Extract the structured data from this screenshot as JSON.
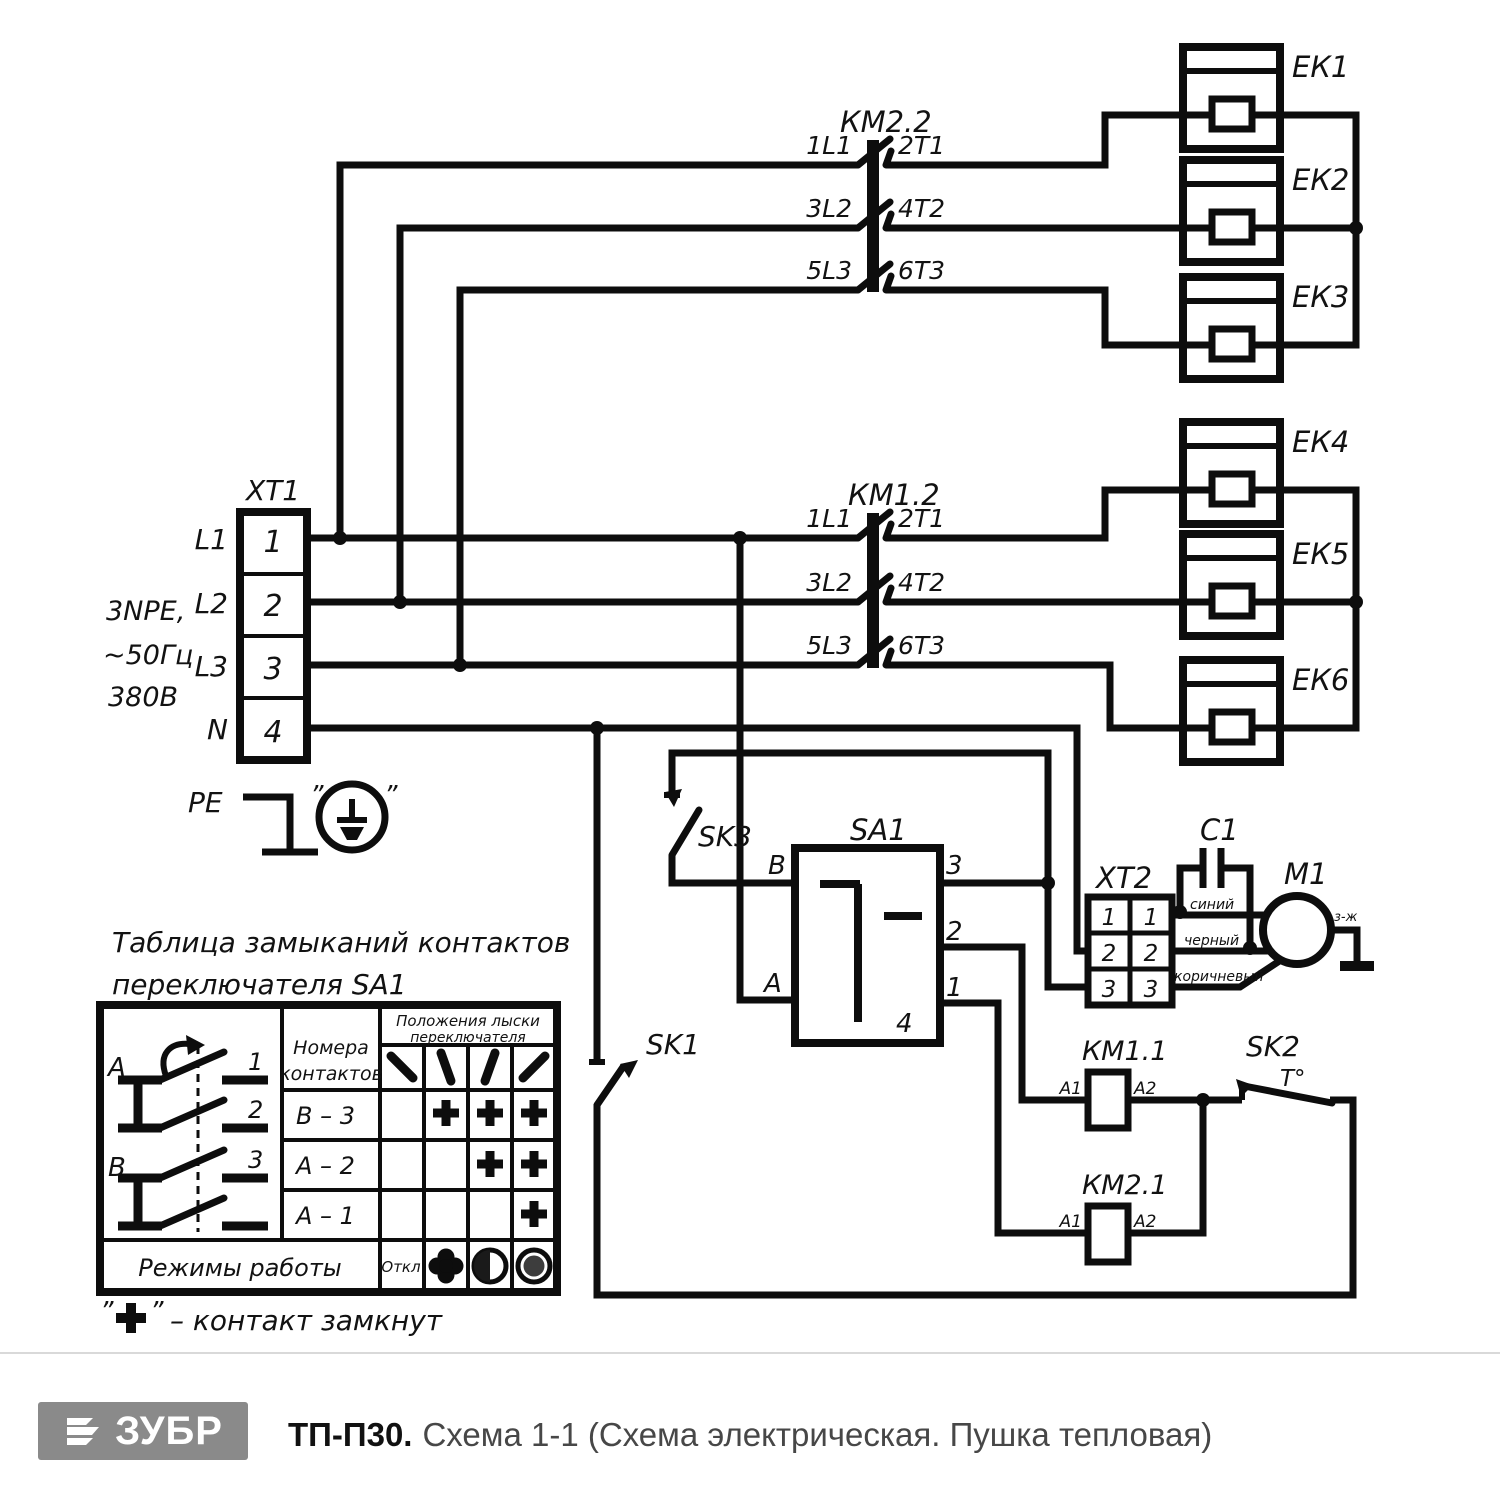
{
  "schematic": {
    "quote": "”",
    "xt1": {
      "title": "ХТ1",
      "phases": [
        "L1",
        "L2",
        "L3",
        "N"
      ],
      "terminals": [
        "1",
        "2",
        "3",
        "4"
      ],
      "supply": [
        "3NPE,",
        "~50Гц",
        "380В"
      ],
      "pe": "PE"
    },
    "km22": {
      "title": "КМ2.2",
      "poles": [
        {
          "in": "1L1",
          "out": "2Т1"
        },
        {
          "in": "3L2",
          "out": "4Т2"
        },
        {
          "in": "5L3",
          "out": "6Т3"
        }
      ]
    },
    "km12": {
      "title": "КМ1.2",
      "poles": [
        {
          "in": "1L1",
          "out": "2Т1"
        },
        {
          "in": "3L2",
          "out": "4Т2"
        },
        {
          "in": "5L3",
          "out": "6Т3"
        }
      ]
    },
    "heaters": [
      "ЕК1",
      "ЕК2",
      "ЕК3",
      "ЕК4",
      "ЕК5",
      "ЕК6"
    ],
    "sa1": {
      "title": "SA1",
      "b": "B",
      "a": "A",
      "t3": "3",
      "t2": "2",
      "t1": "1",
      "t4": "4"
    },
    "sk1": "SK1",
    "sk3": "SK3",
    "sk2": {
      "title": "SK2",
      "temp": "Т°"
    },
    "xt2": {
      "title": "ХТ2",
      "left": [
        "1",
        "2",
        "3"
      ],
      "right": [
        "1",
        "2",
        "3"
      ]
    },
    "c1": "С1",
    "m1": "М1",
    "wire_colors": {
      "blue": "синий",
      "black": "черный",
      "brown": "коричневый"
    },
    "ground_mark": "з-ж",
    "km11": {
      "title": "КМ1.1",
      "a1": "А1",
      "a2": "А2"
    },
    "km21": {
      "title": "КМ2.1",
      "a1": "А1",
      "a2": "А2"
    }
  },
  "table": {
    "title_line1": "Таблица замыканий контактов",
    "title_line2": "переключателя SA1",
    "contacts_header": [
      "Номера",
      "контактов"
    ],
    "positions_header": [
      "Положения лыски",
      "переключателя"
    ],
    "rows": [
      {
        "contacts": "B – 3",
        "closed_positions": [
          2,
          3,
          4
        ]
      },
      {
        "contacts": "A – 2",
        "closed_positions": [
          3,
          4
        ]
      },
      {
        "contacts": "A – 1",
        "closed_positions": [
          4
        ]
      }
    ],
    "modes_label": "Режимы работы",
    "mode_off": "Откл",
    "diagram": {
      "a": "A",
      "b": "B",
      "contact_numbers": [
        "1",
        "2",
        "3"
      ]
    },
    "legend_sign": "+",
    "legend_text": "– контакт замкнут"
  },
  "footer": {
    "brand": "ЗУБР",
    "model": "ТП-П30.",
    "subtitle": "Схема 1-1 (Схема электрическая. Пушка тепловая)"
  }
}
